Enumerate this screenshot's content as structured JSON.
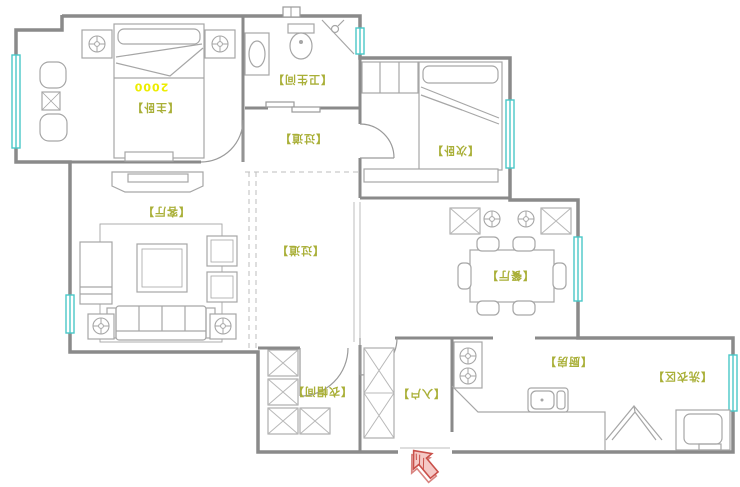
{
  "title": "apartment floor plan",
  "rooms": [
    {
      "id": "master-bedroom",
      "label": "【主卧】"
    },
    {
      "id": "bathroom",
      "label": "【卫生间】"
    },
    {
      "id": "hallway-upper",
      "label": "【过道】"
    },
    {
      "id": "second-bedroom",
      "label": "【次卧】"
    },
    {
      "id": "living-room",
      "label": "【客厅】"
    },
    {
      "id": "hallway",
      "label": "【过道】"
    },
    {
      "id": "dining-room",
      "label": "【餐厅】"
    },
    {
      "id": "cloakroom",
      "label": "【衣帽间】"
    },
    {
      "id": "entry",
      "label": "【入户】"
    },
    {
      "id": "kitchen",
      "label": "【厨房】"
    },
    {
      "id": "laundry",
      "label": "【洗衣区】"
    }
  ],
  "dimensions": {
    "master_bed_width": "2000"
  },
  "icons": {
    "entrance_arrow": "▲"
  },
  "colors": {
    "wall_gray": "#8a8a8a",
    "furniture_gray": "#a6a6a6",
    "window_cyan": "#49c8c8",
    "label_olive": "#a9af37",
    "dimension_yellow": "#eded00",
    "entry_arrow_red": "#c9504a"
  }
}
